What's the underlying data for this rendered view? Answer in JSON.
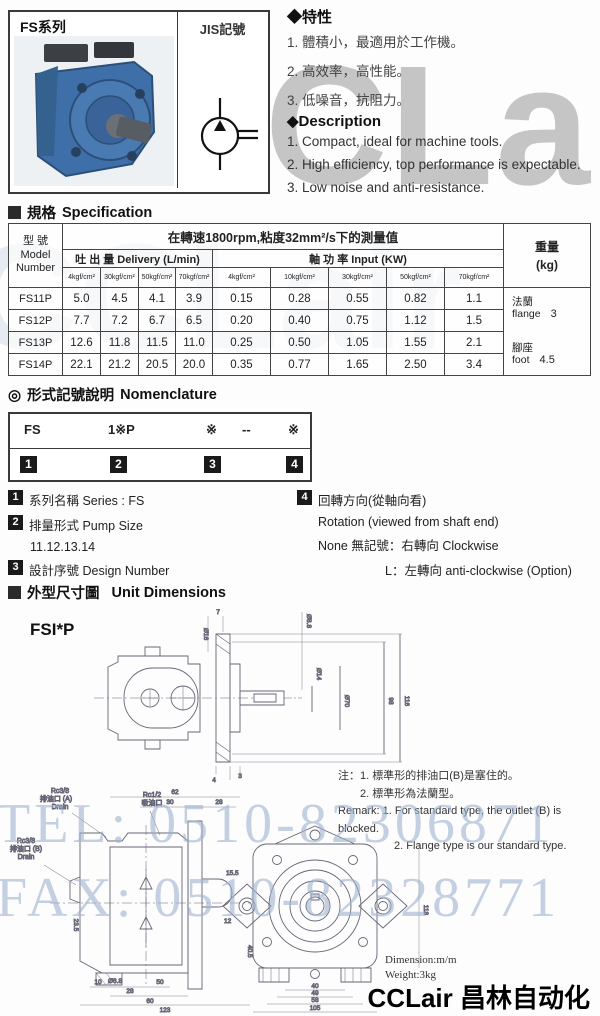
{
  "product_box": {
    "series_label": "FS系列",
    "jis_label": "JIS記號",
    "pump_blue": "#3f6fa8",
    "pump_dark": "#2b4f79"
  },
  "features": {
    "title": "◆特性",
    "items": [
      "1. 體積小，最適用於工作機。",
      "2. 高效率，高性能。",
      "3. 低噪音，抗阻力。"
    ]
  },
  "description": {
    "title": "◆Description",
    "items": [
      "1.  Compact, ideal for machine tools.",
      "2.  High efficiency, top performance is expectable.",
      "3.  Low noise and anti-resistance."
    ]
  },
  "spec": {
    "heading_zh": "規格",
    "heading_en": "Specification",
    "table": {
      "model_header": "型 號",
      "model_header_en1": "Model",
      "model_header_en2": "Number",
      "condition": "在轉速1800rpm,粘度32mm²/s下的測量值",
      "delivery_header": "吐 出 量  Delivery (L/min)",
      "input_header": "軸 功 率   Input (KW)",
      "delivery_cols": [
        "4kgf/cm²",
        "30kgf/cm²",
        "50kgf/cm²",
        "70kgf/cm²"
      ],
      "input_cols": [
        "4kgf/cm²",
        "10kgf/cm²",
        "30kgf/cm²",
        "50kgf/cm²",
        "70kgf/cm²"
      ],
      "weight_header_zh": "重量",
      "weight_header_unit": "(kg)",
      "rows": [
        {
          "model": "FS11P",
          "values": [
            "5.0",
            "4.5",
            "4.1",
            "3.9",
            "0.15",
            "0.28",
            "0.55",
            "0.82",
            "1.1"
          ]
        },
        {
          "model": "FS12P",
          "values": [
            "7.7",
            "7.2",
            "6.7",
            "6.5",
            "0.20",
            "0.40",
            "0.75",
            "1.12",
            "1.5"
          ]
        },
        {
          "model": "FS13P",
          "values": [
            "12.6",
            "11.8",
            "11.5",
            "11.0",
            "0.25",
            "0.50",
            "1.05",
            "1.55",
            "2.1"
          ]
        },
        {
          "model": "FS14P",
          "values": [
            "22.1",
            "21.2",
            "20.5",
            "20.0",
            "0.35",
            "0.77",
            "1.65",
            "2.50",
            "3.4"
          ]
        }
      ],
      "weights": [
        {
          "zh": "法蘭",
          "en": "flange",
          "value": "3"
        },
        {
          "zh": "腳座",
          "en": "foot",
          "value": "4.5"
        }
      ]
    }
  },
  "nomenclature": {
    "bullet": "◎",
    "heading_zh": "形式記號說明",
    "heading_en": "Nomenclature",
    "code_parts": [
      "FS",
      "1※P",
      "※",
      "--",
      "※"
    ],
    "nums": [
      "1",
      "2",
      "3",
      "4"
    ],
    "item1": {
      "num": "1",
      "text": "系列名稱 Series : FS"
    },
    "item2": {
      "num": "2",
      "text": "排量形式 Pump Size",
      "sub": "11.12.13.14"
    },
    "item3": {
      "num": "3",
      "text": "設計序號 Design Number"
    },
    "item4": {
      "num": "4",
      "line1": "回轉方向(從軸向看)",
      "line2": "Rotation (viewed from shaft end)",
      "line3": "None 無記號：右轉向 Clockwise",
      "line4": "L：左轉向 anti-clockwise (Option)"
    }
  },
  "unit_dimensions": {
    "heading_zh": "外型尺寸圖",
    "heading_en": "Unit Dimensions",
    "model_label": "FSI*P",
    "notes": {
      "zh1": "注：1. 標準形的排油口(B)是塞住的。",
      "zh2": "2. 標準形為法蘭型。",
      "en1": "Remark: 1. For standard type, the outlet (B) is blocked.",
      "en2": "2. Flange type is our standard type."
    },
    "top_drawing_dims": {
      "d88": "Ø8.8",
      "d16": "Ø16",
      "d7": "7",
      "d14": "Ø14",
      "d70": "Ø70",
      "d98": "98",
      "d116": "116",
      "d4": "4",
      "d3": "3"
    },
    "left_drawing": {
      "port_a_1": "Rc3/8",
      "port_a_2": "排油口 (A)",
      "port_a_3": "Drain",
      "suction_1": "Rc1/2",
      "suction_2": "吸油口",
      "port_b_1": "Rc3/8",
      "port_b_2": "排油口 (B)",
      "port_b_3": "Drain",
      "d62": "62",
      "d30": "30",
      "d28": "28",
      "d235": "23.5",
      "d155": "15.5",
      "d12": "12",
      "d405": "40.5",
      "d68": "Ø6.8",
      "d10": "10",
      "d28b": "28",
      "d50": "50",
      "d60": "60",
      "d123": "123"
    },
    "front_drawing": {
      "d40": "40",
      "d49": "49",
      "d58": "58",
      "d105": "105",
      "d118": "118"
    },
    "footer": {
      "dimension": "Dimension:m/m",
      "weight": "Weight:3kg"
    }
  },
  "watermarks": {
    "logo": "CCLair",
    "logo_echo": "CCLair",
    "tel": "TEL: 0510-82306871",
    "fax": "FAX: 0510-82328771",
    "logo_color": "#808080",
    "phone_color": "#9eb2d0"
  },
  "brand_footer": "CCLair 昌林自动化"
}
